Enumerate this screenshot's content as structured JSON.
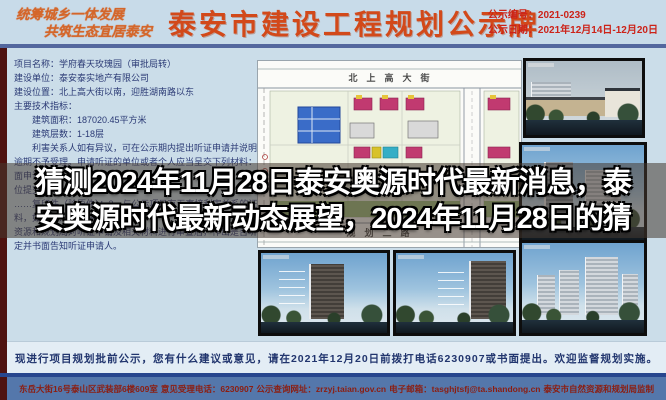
{
  "header": {
    "slogan_line1": "统筹城乡一体发展",
    "slogan_line2": "共筑生态宜居泰安",
    "title": "泰安市建设工程规划公示牌",
    "notice_no": "公示编号：2021-0239",
    "notice_date": "公示日期：2021年12月14日-12月20日"
  },
  "info": {
    "lines": [
      "项目名称：学府春天玫瑰园（审批局转）",
      "建设单位：泰安泰实地产有限公司",
      "建设位置：北上高大街以南，迎胜湖南路以东",
      "主要技术指标：",
      "　　建筑面积：187020.45平方米",
      "　　建筑层数：1-18层",
      "　　利害关系人如有异议，可在公示期内提出听证申请并说明理由，",
      "逾期不予受理。申请听证的单位或者个人应当呈交下列材料：1、书",
      "面申请；2、……",
      "位提交……",
      "……复印件（验原件）；3、与公示项目有无直接利害关系的证明材",
      "料，如房……市自然",
      "资源和规划局对听证申请及相关材料进行审查后，作出是否听证的决",
      "定并书面告知听证申请人。"
    ]
  },
  "map": {
    "street_top": "北　上　高　大　街",
    "street_bottom": "规　划　二　路"
  },
  "overlay": {
    "line1": "猜测2024年11月28日泰安奥源时代最新消息，泰",
    "line2": "安奥源时代最新动态展望，2024年11月28日的猜"
  },
  "notice_row": {
    "text": "现进行项目规划批前公示，您有什么建议或意见，请在2021年12月20日前拨打电话6230907或书面提出。欢迎监督规划实施。"
  },
  "footer": {
    "address": "东岳大街16号泰山区武装部6楼609室",
    "phone": "意见受理电话：6230907",
    "website": "公示查询网址：zrzyj.taian.gov.cn",
    "email": "电子邮箱：tasghjtsfj@ta.shandong.cn",
    "producer": "泰安市自然资源和规划局监制"
  },
  "colors": {
    "title_orange": "#d2491a",
    "header_bg": "#c8dbe9",
    "board_bg": "#cbdde9",
    "footer_bg": "#5477ab",
    "footer_text": "#8c1d10",
    "left_strip": "#4e1210",
    "overlay_tint": "rgba(70,56,47,0.55)",
    "info_text": "#2b3a75"
  }
}
